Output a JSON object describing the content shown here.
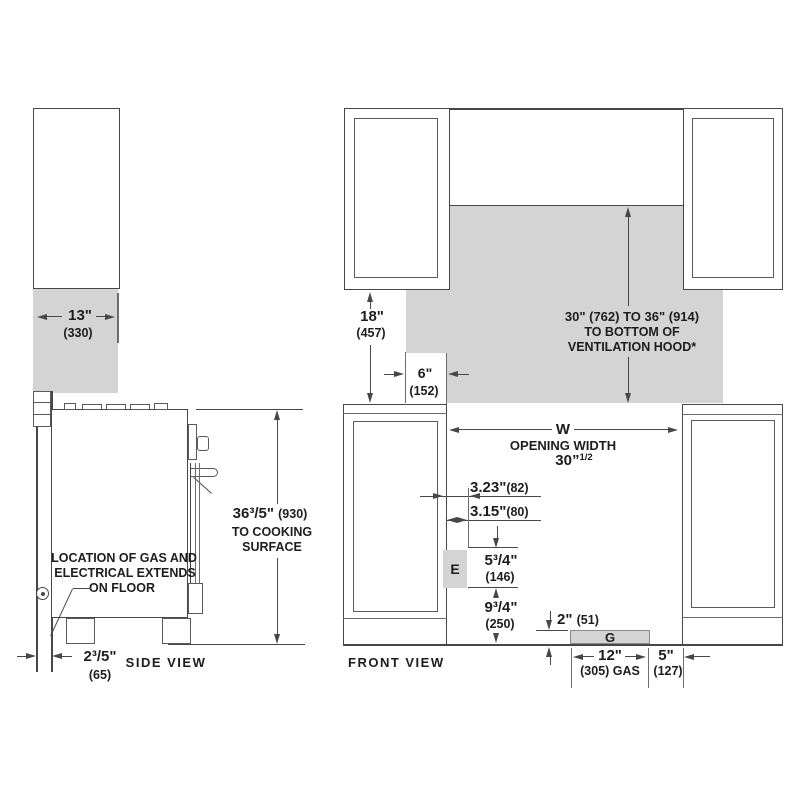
{
  "colors": {
    "line": "#474747",
    "fill": "#d4d4d4",
    "text": "#1d1d1d"
  },
  "side_view": {
    "view_label": "SIDE VIEW",
    "depth": {
      "value": "13\"",
      "mm": "(330)"
    },
    "height": {
      "value": "36³/5\"",
      "mm": "(930)",
      "line2": "TO COOKING",
      "line3": "SURFACE"
    },
    "rear_gap": {
      "value": "2³/5\"",
      "mm": "(65)"
    },
    "gas_note": {
      "line1": "LOCATION OF GAS AND",
      "line2": "ELECTRICAL EXTENDS",
      "line3": "ON FLOOR"
    }
  },
  "front_view": {
    "view_label": "FRONT VIEW",
    "upper_cabinet_height": {
      "value": "18\"",
      "mm": "(457)"
    },
    "hood_overhang": {
      "value": "6\"",
      "mm": "(152)"
    },
    "hood_clearance": {
      "line1": "30\" (762) TO 36\" (914)",
      "line2": "TO BOTTOM OF",
      "line3": "VENTILATION HOOD*"
    },
    "opening": {
      "symbol": "W",
      "label": "OPENING WIDTH",
      "value": "30”",
      "sup": "1/2"
    },
    "electrical_offset_a": {
      "value": "3.23\"",
      "mm": "(82)"
    },
    "electrical_offset_b": {
      "value": "3.15\"",
      "mm": "(80)"
    },
    "electrical_zone_label": "E",
    "electrical_zone_height": {
      "value": "5³/4\"",
      "mm": "(146)"
    },
    "electrical_zone_floor": {
      "value": "9³/4\"",
      "mm": "(250)"
    },
    "gas_zone_label": "G",
    "gas_zone_height": {
      "value": "2\"",
      "mm": "(51)"
    },
    "gas_zone_width": {
      "value": "12\"",
      "mm": "(305) GAS"
    },
    "gas_zone_right": {
      "value": "5\"",
      "mm": "(127)"
    }
  }
}
